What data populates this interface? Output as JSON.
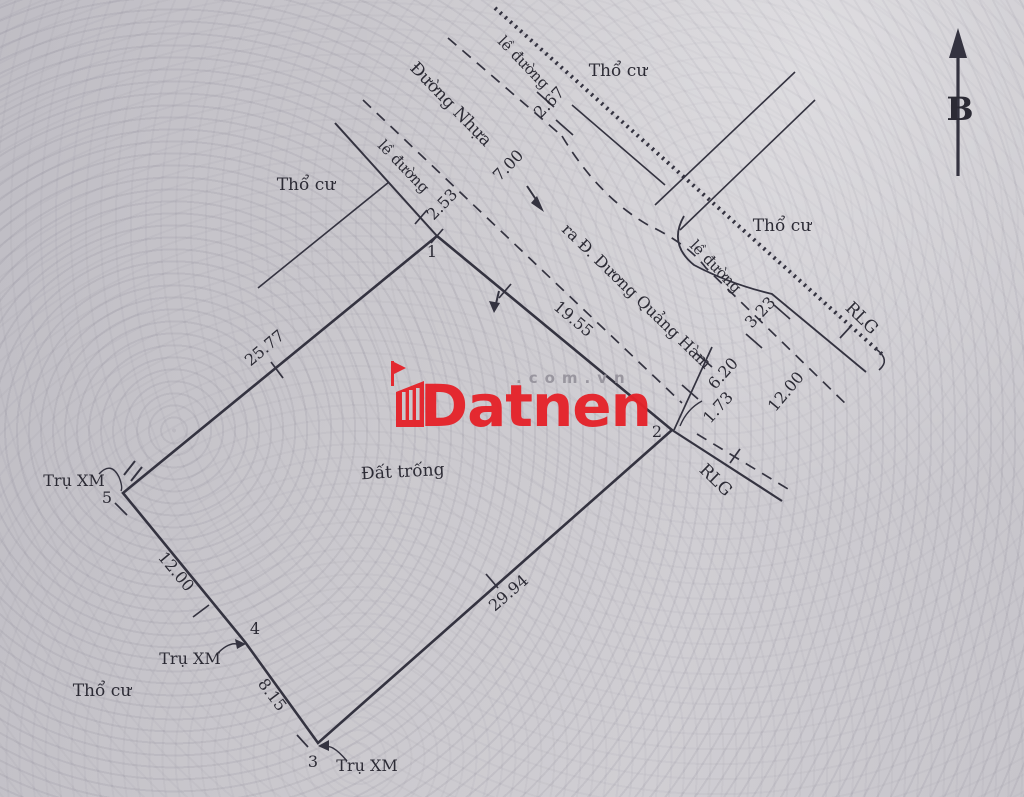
{
  "compass": {
    "north_label": "B"
  },
  "watermark": {
    "brand": "Datnen",
    "suffix": ".com.vn"
  },
  "zones": {
    "tho_cu_top": "Thổ cư",
    "tho_cu_left": "Thổ cư",
    "tho_cu_right": "Thổ cư",
    "tho_cu_bottom": "Thổ cư",
    "dat_trong": "Đất trống"
  },
  "roads": {
    "duong_nhua": "Đường Nhựa",
    "direction_note": "ra Đ. Dương Quảng Hàm",
    "le_duong_top": "lề đường",
    "le_duong_left": "lề đường",
    "le_duong_right": "lề đường",
    "rlg_top": "RLG",
    "rlg_bottom": "RLG"
  },
  "markers": {
    "tru_xm_5": "Trụ XM",
    "tru_xm_4": "Trụ XM",
    "tru_xm_3": "Trụ XM"
  },
  "vertices": {
    "v1": "1",
    "v2": "2",
    "v3": "3",
    "v4": "4",
    "v5": "5"
  },
  "measurements": {
    "edge_1_2": "19.55",
    "edge_2_3": "29.94",
    "edge_3_4": "8.15",
    "edge_4_5": "12.00",
    "edge_5_1": "25.77",
    "sidewalk_top": "2.67",
    "road_width": "7.00",
    "sidewalk_at_1": "2.53",
    "sidewalk_right": "3.23",
    "right_corridor": "12.00",
    "right_asphalt": "6.20",
    "right_offset": "1.73"
  },
  "colors": {
    "ink": "#343340",
    "brand_red": "#e5232a",
    "suffix_gray": "#97949d"
  }
}
